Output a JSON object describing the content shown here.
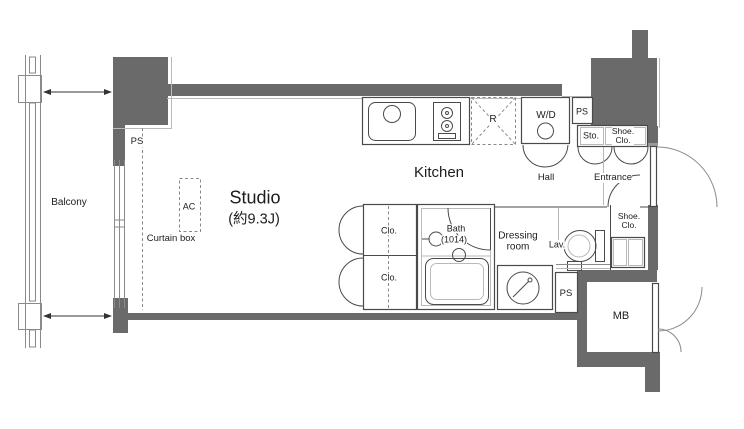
{
  "floorplan": {
    "type": "studio apartment floor plan",
    "labels": {
      "balcony": "Balcony",
      "ps_top_left": "PS",
      "ac_unit": "AC",
      "curtain_box": "Curtain box",
      "studio": "Studio",
      "studio_area": "(約9.3J)",
      "kitchen": "Kitchen",
      "refrigerator_space": "R",
      "washer_dryer": "W/D",
      "ps_top_right": "PS",
      "storage": "Sto.",
      "shoe_closet_upper_line1": "Shoe.",
      "shoe_closet_upper_line2": "Clo.",
      "hall": "Hall",
      "entrance": "Entrance",
      "closet_upper": "Clo.",
      "closet_lower": "Clo.",
      "bath": "Bath",
      "bath_size": "(1014)",
      "dressing_room_line1": "Dressing",
      "dressing_room_line2": "room",
      "lavatory": "Lav.",
      "shoe_closet_lower_line1": "Shoe.",
      "shoe_closet_lower_line2": "Clo.",
      "ps_bottom": "PS",
      "meter_box": "MB"
    },
    "colors": {
      "wall": "#6a6a6a",
      "fixture_line": "#4a4a4a",
      "light_line": "#b9b9b9",
      "background": "#ffffff",
      "text": "#1c1c1c"
    }
  }
}
